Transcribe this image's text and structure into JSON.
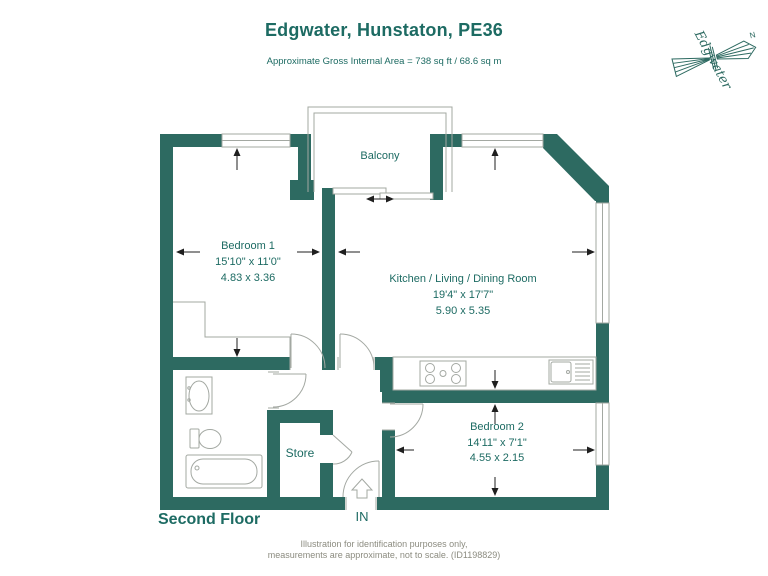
{
  "header": {
    "title": "Edgwater, Hunstaton, PE36",
    "subtitle": "Approximate Gross Internal Area = 738 sq ft / 68.6 sq m"
  },
  "logo": {
    "name": "Edgwater",
    "north_label": "N"
  },
  "plan": {
    "floor_label": "Second Floor",
    "entrance_label": "IN",
    "rooms": {
      "balcony": {
        "name": "Balcony"
      },
      "bedroom1": {
        "name": "Bedroom 1",
        "imperial": "15'10\" x 11'0\"",
        "metric": "4.83 x 3.36"
      },
      "kitchen": {
        "name": "Kitchen / Living / Dining Room",
        "imperial": "19'4\" x 17'7\"",
        "metric": "5.90 x 5.35"
      },
      "bedroom2": {
        "name": "Bedroom 2",
        "imperial": "14'11\" x 7'1\"",
        "metric": "4.55 x 2.15"
      },
      "store": {
        "name": "Store"
      }
    }
  },
  "footer": {
    "line1": "Illustration for identification purposes only,",
    "line2": "measurements are approximate, not to scale. (ID1198829)"
  },
  "colors": {
    "wall": "#2D6A61",
    "label_text": "#1D6B63",
    "fixture_line": "#A3A8A2",
    "dimension_line": "#1f1f1f",
    "footer_text": "#8C8C80"
  }
}
